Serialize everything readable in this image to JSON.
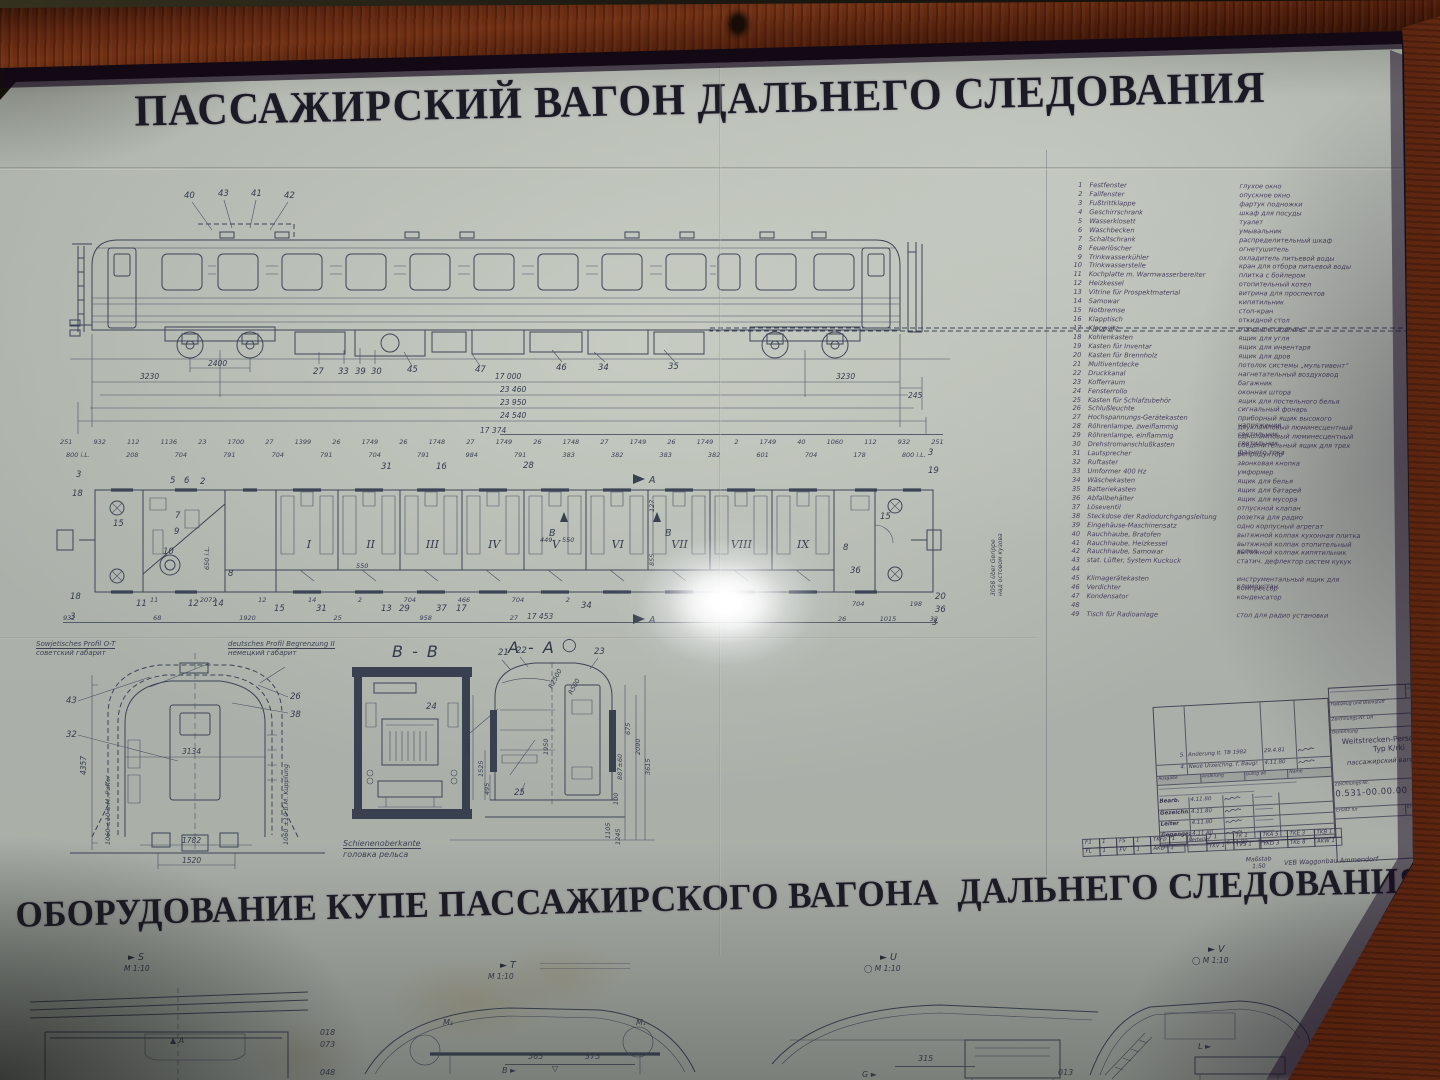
{
  "titles": {
    "top": "ПАССАЖИРСКИЙ ВАГОН ДАЛЬНЕГО СЛЕДОВАНИЯ",
    "bottom": "ОБОРУДОВАНИЕ КУПЕ ПАССАЖИРСКОГО ВАГОНА  ДАЛЬНЕГО СЛЕДОВАНИЯ"
  },
  "colors": {
    "paper": "#afb5ad",
    "ink": "#3d4456",
    "frame_wood": "#4e200d",
    "title_ink": "#1b1b25"
  },
  "legend": {
    "items": [
      {
        "no": "1",
        "de": "Festfenster",
        "ru": "глухое окно"
      },
      {
        "no": "2",
        "de": "Fallfenster",
        "ru": "опускное окно"
      },
      {
        "no": "3",
        "de": "Fußtrittklappe",
        "ru": "фартук подножки"
      },
      {
        "no": "4",
        "de": "Geschirrschrank",
        "ru": "шкаф для посуды"
      },
      {
        "no": "5",
        "de": "Wasserklosett",
        "ru": "туалет"
      },
      {
        "no": "6",
        "de": "Waschbecken",
        "ru": "умывальник"
      },
      {
        "no": "7",
        "de": "Schaltschrank",
        "ru": "распределительный шкаф"
      },
      {
        "no": "8",
        "de": "Feuerlöscher",
        "ru": "огнетушитель"
      },
      {
        "no": "9",
        "de": "Trinkwasserkühler",
        "ru": "охладитель питьевой воды"
      },
      {
        "no": "10",
        "de": "Trinkwasserstelle",
        "ru": "кран для отбора питьевой воды"
      },
      {
        "no": "11",
        "de": "Kochplatte m. Warmwasserbereiter",
        "ru": "плитка с бойлером"
      },
      {
        "no": "12",
        "de": "Heizkessel",
        "ru": "отопительный котел"
      },
      {
        "no": "13",
        "de": "Vitrine für Prospektmaterial",
        "ru": "витрина для проспектов"
      },
      {
        "no": "14",
        "de": "Samowar",
        "ru": "кипятильник"
      },
      {
        "no": "15",
        "de": "Notbremse",
        "ru": "стоп-кран"
      },
      {
        "no": "16",
        "de": "Klapptisch",
        "ru": "откидной стол"
      },
      {
        "no": "17",
        "de": "Klappsitz",
        "ru": "откидное сиденье"
      },
      {
        "no": "18",
        "de": "Kohlenkasten",
        "ru": "ящик для угля"
      },
      {
        "no": "19",
        "de": "Kasten für Inventar",
        "ru": "ящик для инвентаря"
      },
      {
        "no": "20",
        "de": "Kasten für Brennholz",
        "ru": "ящик для дров"
      },
      {
        "no": "21",
        "de": "Multiventdecke",
        "ru": "потолок системы „мультивент“"
      },
      {
        "no": "22",
        "de": "Druckkanal",
        "ru": "нагнетательный воздуховод"
      },
      {
        "no": "23",
        "de": "Kofferraum",
        "ru": "багажник"
      },
      {
        "no": "24",
        "de": "Fensterrollo",
        "ru": "оконная штора"
      },
      {
        "no": "25",
        "de": "Kasten für Schlafzubehör",
        "ru": "ящик для постельного белья"
      },
      {
        "no": "26",
        "de": "Schlußleuchte",
        "ru": "сигнальный фонарь"
      },
      {
        "no": "27",
        "de": "Hochspannungs-Gerätekasten",
        "ru": "приборный ящик высокого напряжения"
      },
      {
        "no": "28",
        "de": "Röhrenlampe, zweiflammig",
        "ru": "двухламповый люминесцентный светильник"
      },
      {
        "no": "29",
        "de": "Röhrenlampe, einflammig",
        "ru": "одноламповый люминесцентный светильник"
      },
      {
        "no": "30",
        "de": "Drehstromanschlußkasten",
        "ru": "соединительный ящик для трех фазного тока"
      },
      {
        "no": "31",
        "de": "Lautsprecher",
        "ru": "репродуктор"
      },
      {
        "no": "32",
        "de": "Ruftaster",
        "ru": "звонковая кнопка"
      },
      {
        "no": "33",
        "de": "Umformer 400 Hz",
        "ru": "умформер"
      },
      {
        "no": "34",
        "de": "Wäschekasten",
        "ru": "ящик для белья"
      },
      {
        "no": "35",
        "de": "Batteriekasten",
        "ru": "ящик для батарей"
      },
      {
        "no": "36",
        "de": "Abfallbehälter",
        "ru": "ящик для мусора"
      },
      {
        "no": "37",
        "de": "Löseventil",
        "ru": "отпускной клапан"
      },
      {
        "no": "38",
        "de": "Steckdose der Radiodurchgangsleitung",
        "ru": "розетка для радио"
      },
      {
        "no": "39",
        "de": "Eingehäuse-Maschinensatz",
        "ru": "одно корпусный агрегат"
      },
      {
        "no": "40",
        "de": "Rauchhaube, Bratofen",
        "ru": "вытяжной колпак кухонная плитка"
      },
      {
        "no": "41",
        "de": "Rauchhaube, Heizkessel",
        "ru": "вытяжной колпак отопительный котел"
      },
      {
        "no": "42",
        "de": "Rauchhaube, Samowar",
        "ru": "вытяжной колпак кипятильник"
      },
      {
        "no": "43",
        "de": "stat. Lüfter, System Kuckuck",
        "ru": "статич. дефлектор систем кукук"
      },
      {
        "no": "44",
        "de": "",
        "ru": ""
      },
      {
        "no": "45",
        "de": "Klimagerätekasten",
        "ru": "инструментальный ящик для климоустан."
      },
      {
        "no": "46",
        "de": "Verdichter",
        "ru": "компрессор"
      },
      {
        "no": "47",
        "de": "Kondensator",
        "ru": "конденсатор"
      },
      {
        "no": "48",
        "de": "",
        "ru": ""
      },
      {
        "no": "49",
        "de": "Tisch für Radioanlage",
        "ru": "стол для радио установки"
      }
    ]
  },
  "side_view": {
    "callouts_roof": [
      "40",
      "43",
      "41",
      "42"
    ],
    "callouts_under": [
      "27",
      "33",
      "39",
      "30",
      "45",
      "47"
    ],
    "callouts_under2": [
      "46",
      "34",
      "35"
    ],
    "dim_wheelbase": "2400",
    "dim_bogie_left": "3230",
    "dim_bogie_right": "3230",
    "dim_buffer": "245",
    "dim_lengths": [
      "17 000",
      "23 460",
      "23 950",
      "24 540"
    ]
  },
  "plan": {
    "overall_top": "17 374",
    "overall_bottom": "17 453",
    "dims_top": [
      "251",
      "932",
      "112",
      "1136",
      "23",
      "1700",
      "27",
      "1399",
      "26",
      "1749",
      "26",
      "1748",
      "27",
      "1749",
      "26",
      "1748",
      "27",
      "1749",
      "26",
      "1749",
      "2",
      "1749",
      "40",
      "1060",
      "112",
      "932",
      "251"
    ],
    "dims_sub": [
      "800 i.L.",
      "208",
      "704",
      "791",
      "704",
      "791",
      "704",
      "791",
      "984",
      "791",
      "383",
      "382",
      "383",
      "382",
      "601",
      "704",
      "178",
      "800 i.L."
    ],
    "dims_bottom1": [
      "11",
      "2072",
      "12",
      "14",
      "2",
      "704",
      "466",
      "704",
      "2"
    ],
    "dims_bottom2": [
      "932",
      "68",
      "1920",
      "25",
      "958",
      "27"
    ],
    "cluster1": [
      "704",
      "198"
    ],
    "cluster2": [
      "26",
      "1015",
      "32"
    ],
    "compartments": [
      "I",
      "II",
      "III",
      "IV",
      "V",
      "VI",
      "VII",
      "VIII",
      "IX"
    ],
    "inner_dims": [
      {
        "t": "550",
        "x": 356,
        "y": 562
      },
      {
        "t": "449",
        "x": 540,
        "y": 536
      },
      {
        "t": "550",
        "x": 562,
        "y": 536
      },
      {
        "t": "650 i.L.",
        "x": 203,
        "y": 570,
        "rot": 1
      },
      {
        "t": "855",
        "x": 648,
        "y": 566,
        "rot": 1
      },
      {
        "t": "127",
        "x": 648,
        "y": 512,
        "rot": 1
      }
    ],
    "note_right_de": "3058 über Gerippe",
    "note_right_ru": "над остовом кузова",
    "cut_a": "A",
    "cut_b": "B",
    "callouts": [
      {
        "t": "3",
        "x": 76,
        "y": 470
      },
      {
        "t": "18",
        "x": 72,
        "y": 489
      },
      {
        "t": "5",
        "x": 170,
        "y": 476
      },
      {
        "t": "6",
        "x": 184,
        "y": 476
      },
      {
        "t": "2",
        "x": 200,
        "y": 477
      },
      {
        "t": "7",
        "x": 175,
        "y": 511
      },
      {
        "t": "9",
        "x": 174,
        "y": 527
      },
      {
        "t": "15",
        "x": 113,
        "y": 519
      },
      {
        "t": "10",
        "x": 163,
        "y": 547
      },
      {
        "t": "8",
        "x": 228,
        "y": 569
      },
      {
        "t": "18",
        "x": 70,
        "y": 592
      },
      {
        "t": "3",
        "x": 70,
        "y": 612
      },
      {
        "t": "31",
        "x": 381,
        "y": 462
      },
      {
        "t": "16",
        "x": 436,
        "y": 462
      },
      {
        "t": "28",
        "x": 523,
        "y": 461
      },
      {
        "t": "3",
        "x": 928,
        "y": 448
      },
      {
        "t": "19",
        "x": 928,
        "y": 466
      },
      {
        "t": "15",
        "x": 880,
        "y": 512
      },
      {
        "t": "8",
        "x": 843,
        "y": 543
      },
      {
        "t": "36",
        "x": 850,
        "y": 566
      },
      {
        "t": "20",
        "x": 935,
        "y": 592
      },
      {
        "t": "36",
        "x": 935,
        "y": 605
      },
      {
        "t": "3",
        "x": 932,
        "y": 618
      },
      {
        "t": "11",
        "x": 136,
        "y": 599
      },
      {
        "t": "12",
        "x": 188,
        "y": 599
      },
      {
        "t": "14",
        "x": 213,
        "y": 599
      },
      {
        "t": "15",
        "x": 274,
        "y": 604
      },
      {
        "t": "31",
        "x": 316,
        "y": 604
      },
      {
        "t": "13",
        "x": 381,
        "y": 604
      },
      {
        "t": "29",
        "x": 399,
        "y": 604
      },
      {
        "t": "37",
        "x": 436,
        "y": 604
      },
      {
        "t": "17",
        "x": 456,
        "y": 604
      },
      {
        "t": "34",
        "x": 581,
        "y": 601
      }
    ]
  },
  "sections": {
    "profile": {
      "label1_de": "Sowjetisches Profil O-T",
      "label1_ru": "советский габарит",
      "label2_de": "deutsches Profil Begrenzung II",
      "label2_ru": "немецкий габарит",
      "dim_height": "4357",
      "dim_width": "3134",
      "dim_1782": "1782",
      "dim_gauge": "1520",
      "note_left": "1060 ±10 b.M. Puffer",
      "note_right": "1060 ±10 b.M. Kupplung",
      "callouts": [
        "43",
        "26",
        "38",
        "32"
      ]
    },
    "bb": {
      "title": "B - B",
      "callout": "24",
      "rail_de": "Schienenoberkante",
      "rail_ru": "головка рельса"
    },
    "aa": {
      "title": "A - A",
      "symbol": "◯",
      "callouts": [
        "21",
        "22",
        "23",
        "25"
      ],
      "dims_left": [
        "2562",
        "1525",
        "495"
      ],
      "dims_right": [
        "675",
        "2090",
        "887±60",
        "100",
        "3615",
        "1105",
        "1245"
      ],
      "dims_misc": [
        "R2500",
        "R500",
        "1950"
      ]
    }
  },
  "title_block": {
    "rev_rows": [
      {
        "no": "5.",
        "text": "Änderung lt. TB 1982",
        "date": "29.4.81"
      },
      {
        "no": "4.",
        "text": "Neue Urzeichng. f. Baugr.",
        "date": "4.11.80"
      }
    ],
    "col_headers": [
      "Ausgabe",
      "Änderung",
      "Gültig ab",
      "Name"
    ],
    "sign_rows": [
      {
        "label": "Bearb.",
        "date": "4.11.80"
      },
      {
        "label": "Gezeichn.",
        "date": "4.11.80"
      },
      {
        "label": "Leiter",
        "date": "4.11.80"
      },
      {
        "label": "Gegengez.",
        "date": "4.11.80"
      }
    ],
    "check_date": "6.11.80",
    "field_material": "Halbzeug und Werkstoff",
    "field_zng": "Zeichnungs-Nr. DR",
    "field_benennung": "Benennung",
    "name_de": "Weitstrecken-Personenw.",
    "name_type": "Typ K/rki",
    "name_ru": "пассажирский вагон тип",
    "field_drawing_no": "Zeichnungs-Nr.",
    "drawing_no": "0.531-00.00.00 · 07",
    "field_ersatz": "Ersatz für",
    "field_ersetzt": "Ersetzt durch",
    "maker": "VEB Waggonbau Ammendorf",
    "scale_label": "Maßstab",
    "scale": "1:50",
    "dist_label": "Verteiler",
    "dist_row1": [
      "F1",
      "1",
      "FS",
      "1",
      "TKFp",
      "1"
    ],
    "dist_row2": [
      "FL",
      "1",
      "FV",
      "1",
      "AKD",
      "1"
    ],
    "dist_row3": [
      "T 1",
      "TK 1",
      "TKA 5",
      "TKE 3",
      "TKB 1"
    ],
    "dist_row4": [
      "TKV 1",
      "TVS 1",
      "TKD 3",
      "TKE 8",
      "AKW 1"
    ]
  },
  "strip": {
    "scale": "M 1:10",
    "m_s": "S",
    "m_t": "T",
    "m_u": "U",
    "m_v": "V",
    "a": "A",
    "b": "B",
    "g": "G",
    "l": "L",
    "detail": "M₁",
    "d565": "565",
    "d375": "375",
    "d315": "315",
    "l018": "018",
    "l073": "073",
    "l048": "048",
    "l013": "013"
  }
}
